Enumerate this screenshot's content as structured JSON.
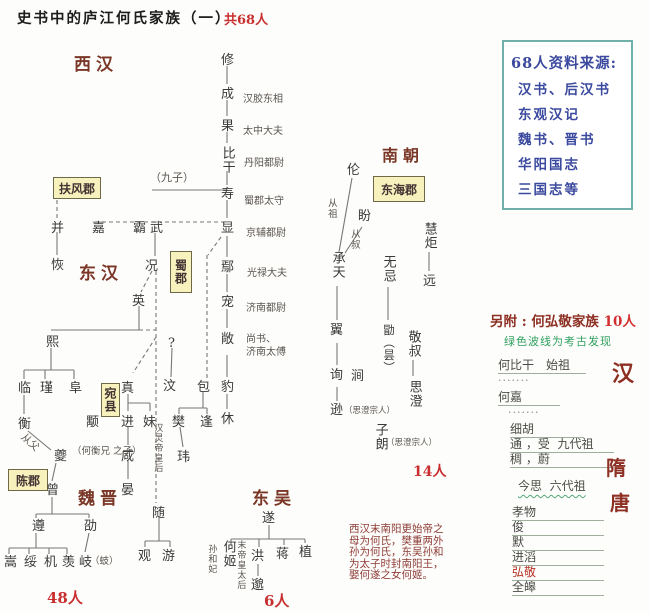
{
  "header": {
    "title": "史书中的庐江何氏家族（一）",
    "total_count": "共68人"
  },
  "eras": [
    {
      "t": "西汉",
      "x": 74,
      "y": 50
    },
    {
      "t": "东汉",
      "x": 79,
      "y": 259
    },
    {
      "t": "魏晋",
      "x": 78,
      "y": 484
    },
    {
      "t": "东吴",
      "x": 252,
      "y": 484
    },
    {
      "t": "南朝",
      "x": 382,
      "y": 142,
      "s": 16
    }
  ],
  "region_boxes": [
    {
      "t": "扶风郡",
      "x": 53,
      "y": 177,
      "w": 46,
      "h": 20
    },
    {
      "t": "东海郡",
      "x": 373,
      "y": 176,
      "w": 50,
      "h": 24
    },
    {
      "t": "陈郡",
      "x": 8,
      "y": 469,
      "w": 38,
      "h": 20
    },
    {
      "t": "蜀郡",
      "x": 170,
      "y": 251,
      "w": 20,
      "h": 40,
      "v": 1
    },
    {
      "t": "宛县",
      "x": 101,
      "y": 383,
      "w": 17,
      "h": 32,
      "v": 1
    }
  ],
  "persons": [
    {
      "t": "修",
      "x": 221,
      "y": 54
    },
    {
      "t": "成",
      "x": 221,
      "y": 88
    },
    {
      "t": "果",
      "x": 221,
      "y": 120
    },
    {
      "t": "比干",
      "x": 220,
      "y": 146,
      "v": 1
    },
    {
      "t": "寿",
      "x": 221,
      "y": 188
    },
    {
      "t": "显",
      "x": 221,
      "y": 222
    },
    {
      "t": "鄢",
      "x": 221,
      "y": 261
    },
    {
      "t": "宠",
      "x": 221,
      "y": 296
    },
    {
      "t": "敞",
      "x": 221,
      "y": 333
    },
    {
      "t": "豹",
      "x": 221,
      "y": 381
    },
    {
      "t": "休",
      "x": 221,
      "y": 413
    },
    {
      "t": "包",
      "x": 197,
      "y": 381
    },
    {
      "t": "樊",
      "x": 172,
      "y": 416
    },
    {
      "t": "逢",
      "x": 200,
      "y": 416
    },
    {
      "t": "玮",
      "x": 177,
      "y": 451
    },
    {
      "t": "汶",
      "x": 163,
      "y": 380
    },
    {
      "t": "?",
      "x": 168,
      "y": 337
    },
    {
      "t": "并",
      "x": 51,
      "y": 222
    },
    {
      "t": "恢",
      "x": 51,
      "y": 259
    },
    {
      "t": "嘉",
      "x": 92,
      "y": 222
    },
    {
      "t": "霸",
      "x": 133,
      "y": 222
    },
    {
      "t": "武",
      "x": 150,
      "y": 222
    },
    {
      "t": "况",
      "x": 145,
      "y": 260
    },
    {
      "t": "英",
      "x": 132,
      "y": 295
    },
    {
      "t": "熙",
      "x": 46,
      "y": 336
    },
    {
      "t": "临",
      "x": 18,
      "y": 382
    },
    {
      "t": "瑾",
      "x": 40,
      "y": 382
    },
    {
      "t": "阜",
      "x": 69,
      "y": 382
    },
    {
      "t": "衡",
      "x": 18,
      "y": 418
    },
    {
      "t": "颙",
      "x": 86,
      "y": 416
    },
    {
      "t": "真",
      "x": 121,
      "y": 382
    },
    {
      "t": "进",
      "x": 121,
      "y": 416
    },
    {
      "t": "妹",
      "x": 143,
      "y": 416
    },
    {
      "t": "咸",
      "x": 121,
      "y": 450
    },
    {
      "t": "晏",
      "x": 121,
      "y": 484
    },
    {
      "t": "夔",
      "x": 54,
      "y": 450
    },
    {
      "t": "曾",
      "x": 46,
      "y": 484
    },
    {
      "t": "遵",
      "x": 32,
      "y": 520
    },
    {
      "t": "劭",
      "x": 84,
      "y": 520
    },
    {
      "t": "嵩",
      "x": 4,
      "y": 556
    },
    {
      "t": "绥",
      "x": 24,
      "y": 556
    },
    {
      "t": "机",
      "x": 44,
      "y": 556
    },
    {
      "t": "羡",
      "x": 62,
      "y": 556
    },
    {
      "t": "岐",
      "x": 79,
      "y": 556
    },
    {
      "t": "随",
      "x": 152,
      "y": 507
    },
    {
      "t": "观",
      "x": 138,
      "y": 550
    },
    {
      "t": "游",
      "x": 162,
      "y": 550
    },
    {
      "t": "伦",
      "x": 347,
      "y": 164
    },
    {
      "t": "盼",
      "x": 358,
      "y": 210
    },
    {
      "t": "慧炬",
      "x": 422,
      "y": 222,
      "v": 1
    },
    {
      "t": "远",
      "x": 423,
      "y": 275
    },
    {
      "t": "承天",
      "x": 330,
      "y": 251,
      "v": 1
    },
    {
      "t": "无忌",
      "x": 381,
      "y": 255,
      "v": 1
    },
    {
      "t": "翼",
      "x": 330,
      "y": 324
    },
    {
      "t": "勖（昙）",
      "x": 383,
      "y": 324,
      "v": 1,
      "s": 11.5
    },
    {
      "t": "敬叔",
      "x": 406,
      "y": 330,
      "v": 1
    },
    {
      "t": "思澄",
      "x": 407,
      "y": 380,
      "v": 1
    },
    {
      "t": "询",
      "x": 330,
      "y": 369
    },
    {
      "t": "涧",
      "x": 351,
      "y": 370
    },
    {
      "t": "逊",
      "x": 330,
      "y": 404
    },
    {
      "t": "子朗",
      "x": 373,
      "y": 423,
      "v": 1
    },
    {
      "t": "遂",
      "x": 262,
      "y": 512
    },
    {
      "t": "何姬",
      "x": 221,
      "y": 540,
      "v": 1
    },
    {
      "t": "洪",
      "x": 251,
      "y": 550
    },
    {
      "t": "蒋",
      "x": 276,
      "y": 548
    },
    {
      "t": "植",
      "x": 299,
      "y": 546
    },
    {
      "t": "邈",
      "x": 251,
      "y": 579
    }
  ],
  "official_titles": [
    {
      "t": "汉胶东相",
      "x": 243,
      "y": 90
    },
    {
      "t": "太中大夫",
      "x": 243,
      "y": 122
    },
    {
      "t": "丹阳都尉",
      "x": 244,
      "y": 154
    },
    {
      "t": "蜀郡太守",
      "x": 244,
      "y": 192
    },
    {
      "t": "京辅都尉",
      "x": 246,
      "y": 224
    },
    {
      "t": "光禄大夫",
      "x": 247,
      "y": 264
    },
    {
      "t": "济南都尉",
      "x": 246,
      "y": 299
    },
    {
      "t": "尚书、",
      "x": 246,
      "y": 330
    },
    {
      "t": "济南太傅",
      "x": 246,
      "y": 343
    }
  ],
  "small_notes": [
    {
      "t": "（九子）",
      "x": 150,
      "y": 172,
      "s": 11
    },
    {
      "t": "从父",
      "x": 26,
      "y": 432,
      "rot": 42,
      "s": 10
    },
    {
      "t": "（何衡兄\n之子）",
      "x": 72,
      "y": 447,
      "s": 9.5
    },
    {
      "t": "汉灵帝皇后",
      "x": 152,
      "y": 423,
      "v": 1,
      "s": 9
    },
    {
      "t": "（蚑）",
      "x": 90,
      "y": 557,
      "s": 9.5
    },
    {
      "t": "从祖",
      "x": 325,
      "y": 198,
      "v": 1,
      "s": 9.5
    },
    {
      "t": "从叔",
      "x": 348,
      "y": 229,
      "v": 1,
      "s": 9.5
    },
    {
      "t": "（思澄宗人）",
      "x": 344,
      "y": 407,
      "s": 8.5
    },
    {
      "t": "（思澄宗人）",
      "x": 386,
      "y": 439,
      "s": 8.5
    },
    {
      "t": "孙和妃",
      "x": 206,
      "y": 544,
      "v": 1,
      "s": 9
    },
    {
      "t": "末帝皇太后",
      "x": 235,
      "y": 540,
      "v": 1,
      "s": 9
    }
  ],
  "counts": [
    {
      "t": "48人",
      "x": 47,
      "y": 587
    },
    {
      "t": "6人",
      "x": 264,
      "y": 590
    },
    {
      "t": "14人",
      "x": 413,
      "y": 461,
      "s": 14
    }
  ],
  "source_box": {
    "title": "68人资料来源:",
    "items": [
      "汉书、后汉书",
      "东观汉记",
      "魏书、晋书",
      "华阳国志",
      "三国志等"
    ]
  },
  "note_block": {
    "lines": [
      "西汉末南阳更始帝之",
      "母为何氏，樊重两外",
      "孙为何氏，东吴孙和",
      "为太子时封南阳王，",
      "娶何遂之女何姬。"
    ]
  },
  "hongjing_panel": {
    "header": "另附 : 何弘敬家族 ",
    "people_count": "10人",
    "legend": "绿色波线为考古发现",
    "rows": [
      {
        "name": "何比干　始祖",
        "x": 498,
        "y": 356,
        "w": 88
      },
      {
        "dots": "·······",
        "x": 498,
        "y": 374
      },
      {
        "name": "何嘉",
        "x": 498,
        "y": 388,
        "w": 62
      },
      {
        "dots": "·······",
        "x": 508,
        "y": 406
      },
      {
        "name": "细胡",
        "x": 510,
        "y": 420,
        "w": 74
      },
      {
        "name": "通 ，受  九代祖",
        "x": 510,
        "y": 435,
        "w": 104
      },
      {
        "name": "稠 ，蔚",
        "x": 510,
        "y": 450,
        "w": 104
      },
      {
        "name": "今思  六代祖",
        "x": 518,
        "y": 477,
        "w": 98,
        "wavy": true
      },
      {
        "name": "孝物",
        "x": 512,
        "y": 503,
        "w": 92
      },
      {
        "name": "俊",
        "x": 512,
        "y": 518,
        "w": 92
      },
      {
        "name": "默",
        "x": 512,
        "y": 533,
        "w": 92
      },
      {
        "name": "进滔",
        "x": 512,
        "y": 548,
        "w": 92
      },
      {
        "name": "弘敬",
        "x": 512,
        "y": 563,
        "w": 92,
        "red": true
      },
      {
        "name": "全皞",
        "x": 512,
        "y": 578,
        "w": 92
      }
    ],
    "era_marks": [
      {
        "t": "汉",
        "x": 612,
        "y": 356,
        "s": 22
      },
      {
        "t": "隋",
        "x": 606,
        "y": 452,
        "s": 20
      },
      {
        "t": "唐",
        "x": 610,
        "y": 487,
        "s": 20
      }
    ]
  },
  "lines": {
    "solid": [
      [
        227,
        66,
        227,
        84
      ],
      [
        227,
        100,
        227,
        116
      ],
      [
        227,
        132,
        227,
        143
      ],
      [
        227,
        171,
        227,
        185
      ],
      [
        227,
        200,
        227,
        218
      ],
      [
        227,
        236,
        227,
        257
      ],
      [
        227,
        274,
        227,
        292
      ],
      [
        227,
        309,
        227,
        328
      ],
      [
        227,
        355,
        227,
        377
      ],
      [
        227,
        394,
        227,
        409
      ],
      [
        152,
        190,
        227,
        190
      ],
      [
        57,
        232,
        57,
        255
      ],
      [
        155,
        233,
        155,
        256
      ],
      [
        139,
        306,
        139,
        330
      ],
      [
        51,
        330,
        139,
        330
      ],
      [
        51,
        348,
        51,
        370
      ],
      [
        24,
        370,
        74,
        370
      ],
      [
        24,
        370,
        24,
        379
      ],
      [
        45,
        370,
        45,
        379
      ],
      [
        74,
        370,
        74,
        379
      ],
      [
        24,
        395,
        24,
        414
      ],
      [
        28,
        431,
        51,
        450
      ],
      [
        56,
        463,
        52,
        481
      ],
      [
        52,
        497,
        52,
        514
      ],
      [
        36,
        514,
        89,
        514
      ],
      [
        36,
        514,
        36,
        518
      ],
      [
        89,
        514,
        89,
        518
      ],
      [
        36,
        533,
        36,
        548
      ],
      [
        9,
        548,
        67,
        548
      ],
      [
        9,
        548,
        9,
        554
      ],
      [
        29,
        548,
        29,
        554
      ],
      [
        49,
        548,
        49,
        554
      ],
      [
        67,
        548,
        67,
        554
      ],
      [
        89,
        533,
        85,
        552
      ],
      [
        159,
        516,
        159,
        541
      ],
      [
        145,
        541,
        170,
        541
      ],
      [
        145,
        541,
        145,
        547
      ],
      [
        170,
        541,
        170,
        547
      ],
      [
        203,
        392,
        203,
        408
      ],
      [
        179,
        408,
        207,
        408
      ],
      [
        179,
        408,
        179,
        414
      ],
      [
        207,
        408,
        207,
        414
      ],
      [
        180,
        427,
        183,
        447
      ],
      [
        172,
        348,
        171,
        377
      ],
      [
        128,
        394,
        128,
        403
      ],
      [
        128,
        403,
        150,
        403
      ],
      [
        128,
        403,
        128,
        411
      ],
      [
        150,
        403,
        150,
        411
      ],
      [
        128,
        427,
        128,
        445
      ],
      [
        128,
        461,
        128,
        479
      ],
      [
        352,
        178,
        339,
        252
      ],
      [
        362,
        227,
        345,
        253
      ],
      [
        429,
        252,
        429,
        271
      ],
      [
        337,
        286,
        337,
        320
      ],
      [
        388,
        287,
        388,
        320
      ],
      [
        413,
        360,
        413,
        376
      ],
      [
        337,
        343,
        337,
        365
      ],
      [
        337,
        387,
        337,
        401
      ],
      [
        269,
        525,
        269,
        539
      ],
      [
        231,
        539,
        305,
        539
      ],
      [
        231,
        539,
        231,
        545
      ],
      [
        259,
        539,
        259,
        547
      ],
      [
        284,
        539,
        284,
        545
      ],
      [
        305,
        539,
        305,
        543
      ],
      [
        258,
        564,
        258,
        576
      ]
    ],
    "dashed": [
      [
        95,
        222,
        225,
        222
      ],
      [
        57,
        200,
        57,
        219
      ],
      [
        152,
        271,
        141,
        292
      ],
      [
        139,
        330,
        156,
        330
      ],
      [
        156,
        271,
        156,
        503
      ],
      [
        156,
        337,
        133,
        373
      ],
      [
        221,
        237,
        208,
        255
      ],
      [
        207,
        255,
        207,
        378
      ]
    ]
  },
  "colors": {
    "accent_red": "#c92f2f",
    "era_maroon": "#7a3626",
    "source_blue": "#3b4a9e",
    "source_border_teal": "#6fb0aa",
    "legend_green": "#2fa05f",
    "region_box_yellow": "#f7f2bd",
    "line_gray": "#777777"
  }
}
